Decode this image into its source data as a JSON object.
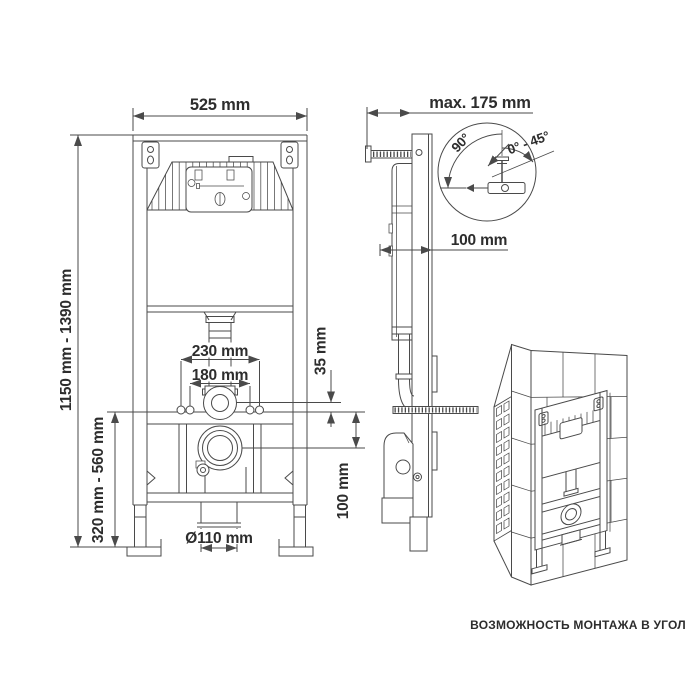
{
  "front_view": {
    "width": "525 mm",
    "height_range": "1150 mm - 1390 mm",
    "lower_height_range": "320 mm - 560 mm",
    "bolt_spacing_outer": "230 mm",
    "bolt_spacing_inner": "180 mm",
    "inlet_to_rail": "35 mm",
    "rail_to_drain": "100 mm",
    "outlet_diameter": "Ø110 mm"
  },
  "side_view": {
    "max_wall_distance": "max. 175 mm",
    "frame_depth": "100 mm"
  },
  "angle_detail": {
    "angle_perpendicular": "90°",
    "angle_adjustable": "0° - 45°"
  },
  "corner_view": {
    "caption": "ВОЗМОЖНОСТЬ МОНТАЖА В УГОЛ"
  },
  "colors": {
    "line": "#4a4a4a",
    "text": "#2d2d2d",
    "background": "#ffffff"
  }
}
